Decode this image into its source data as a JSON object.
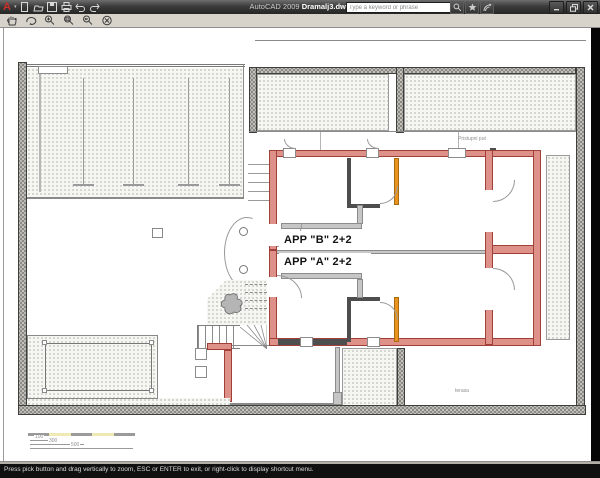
{
  "window": {
    "app_title": "AutoCAD 2009",
    "doc_title": "Dramalj3.dwg",
    "search_placeholder": "Type a keyword or phrase",
    "quick_access_icons": [
      "new-file",
      "open-file",
      "save",
      "plot",
      "undo",
      "redo"
    ],
    "infocenter_icons": [
      "search",
      "favorites-star",
      "communication-center"
    ],
    "window_controls": [
      "minimize",
      "restore",
      "close"
    ]
  },
  "zoom_toolbar": {
    "icons": [
      "pan",
      "orbit",
      "zoom-realtime",
      "zoom-window",
      "zoom-previous",
      "exit-zoom"
    ]
  },
  "plan": {
    "labels": {
      "apartment_b": "APP \"B\" 2+2",
      "apartment_a": "APP \"A\" 2+2",
      "access_road": "Pristupni put",
      "terrace": "terasa"
    },
    "scale_bar": {
      "dims": [
        "100",
        "300",
        "500"
      ]
    },
    "colors": {
      "wall_fill": "#DE9189",
      "wall_outline": "#A04038",
      "accent_orange": "#E8941E",
      "partition_gray": "#C6C6C6",
      "partition_dark": "#4E4E4E",
      "canvas": "#FFFFFF",
      "titlebar": "#3B3B3B"
    }
  },
  "status_bar": {
    "prompt": "Press pick button and drag vertically to zoom, ESC or ENTER to exit, or right-click to display shortcut menu."
  }
}
